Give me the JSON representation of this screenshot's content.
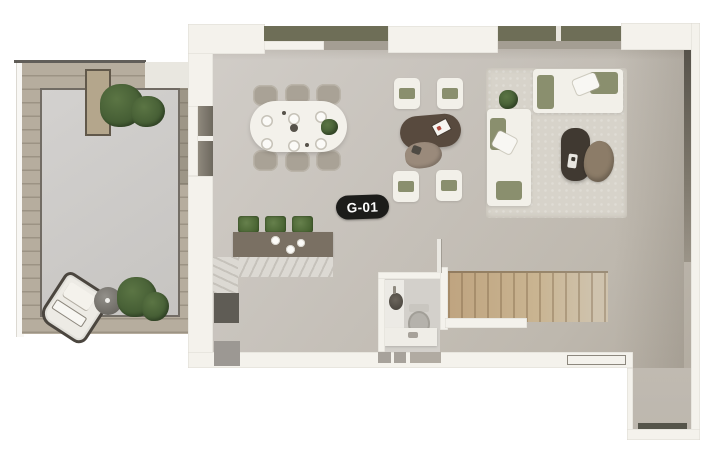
{
  "unit": {
    "label": "G-01"
  },
  "palette": {
    "wall": "#f4f2ec",
    "windowOlive": "#6e6e57",
    "sill": "#a49e93",
    "glazing": "#6d685e",
    "deck": "#b6ad9e",
    "courtyardA": "#d3d1cf",
    "courtyardB": "#c6c4c1",
    "planterTan": "#b4a68c",
    "plantGreen": "#5b7544",
    "plantDark": "#3f5730",
    "darkLine": "#45423c",
    "floorA": "#d2cec9",
    "floorB": "#c7c2bb",
    "floorC": "#b3aca1",
    "stairsA": "#bfa480",
    "stairsB": "#cfc3ae",
    "counterDark": "#7a7063",
    "marble": "#dcd9d3",
    "appliance": "#5f5c55",
    "doorGray": "#9c9893",
    "chairGray": "#a9a296",
    "plate": "#fbfaf7",
    "rug": "#d7d3ca",
    "sofa": "#f2f0e9",
    "cushion": "#8a8f6e",
    "coffeeDark": "#403931",
    "ottoman": "#8c7c68",
    "ovalTable": "#584a3e",
    "blobTable": "#9a8a7b",
    "toilet": "#b5b2ac",
    "sinkDark": "#4d4841",
    "badgeBg": "#1c1c1a",
    "badgeText": "#ffffff",
    "matLine": "#8d887e",
    "threshold": "#55544a",
    "entryFloor": "#bdb7ae"
  }
}
